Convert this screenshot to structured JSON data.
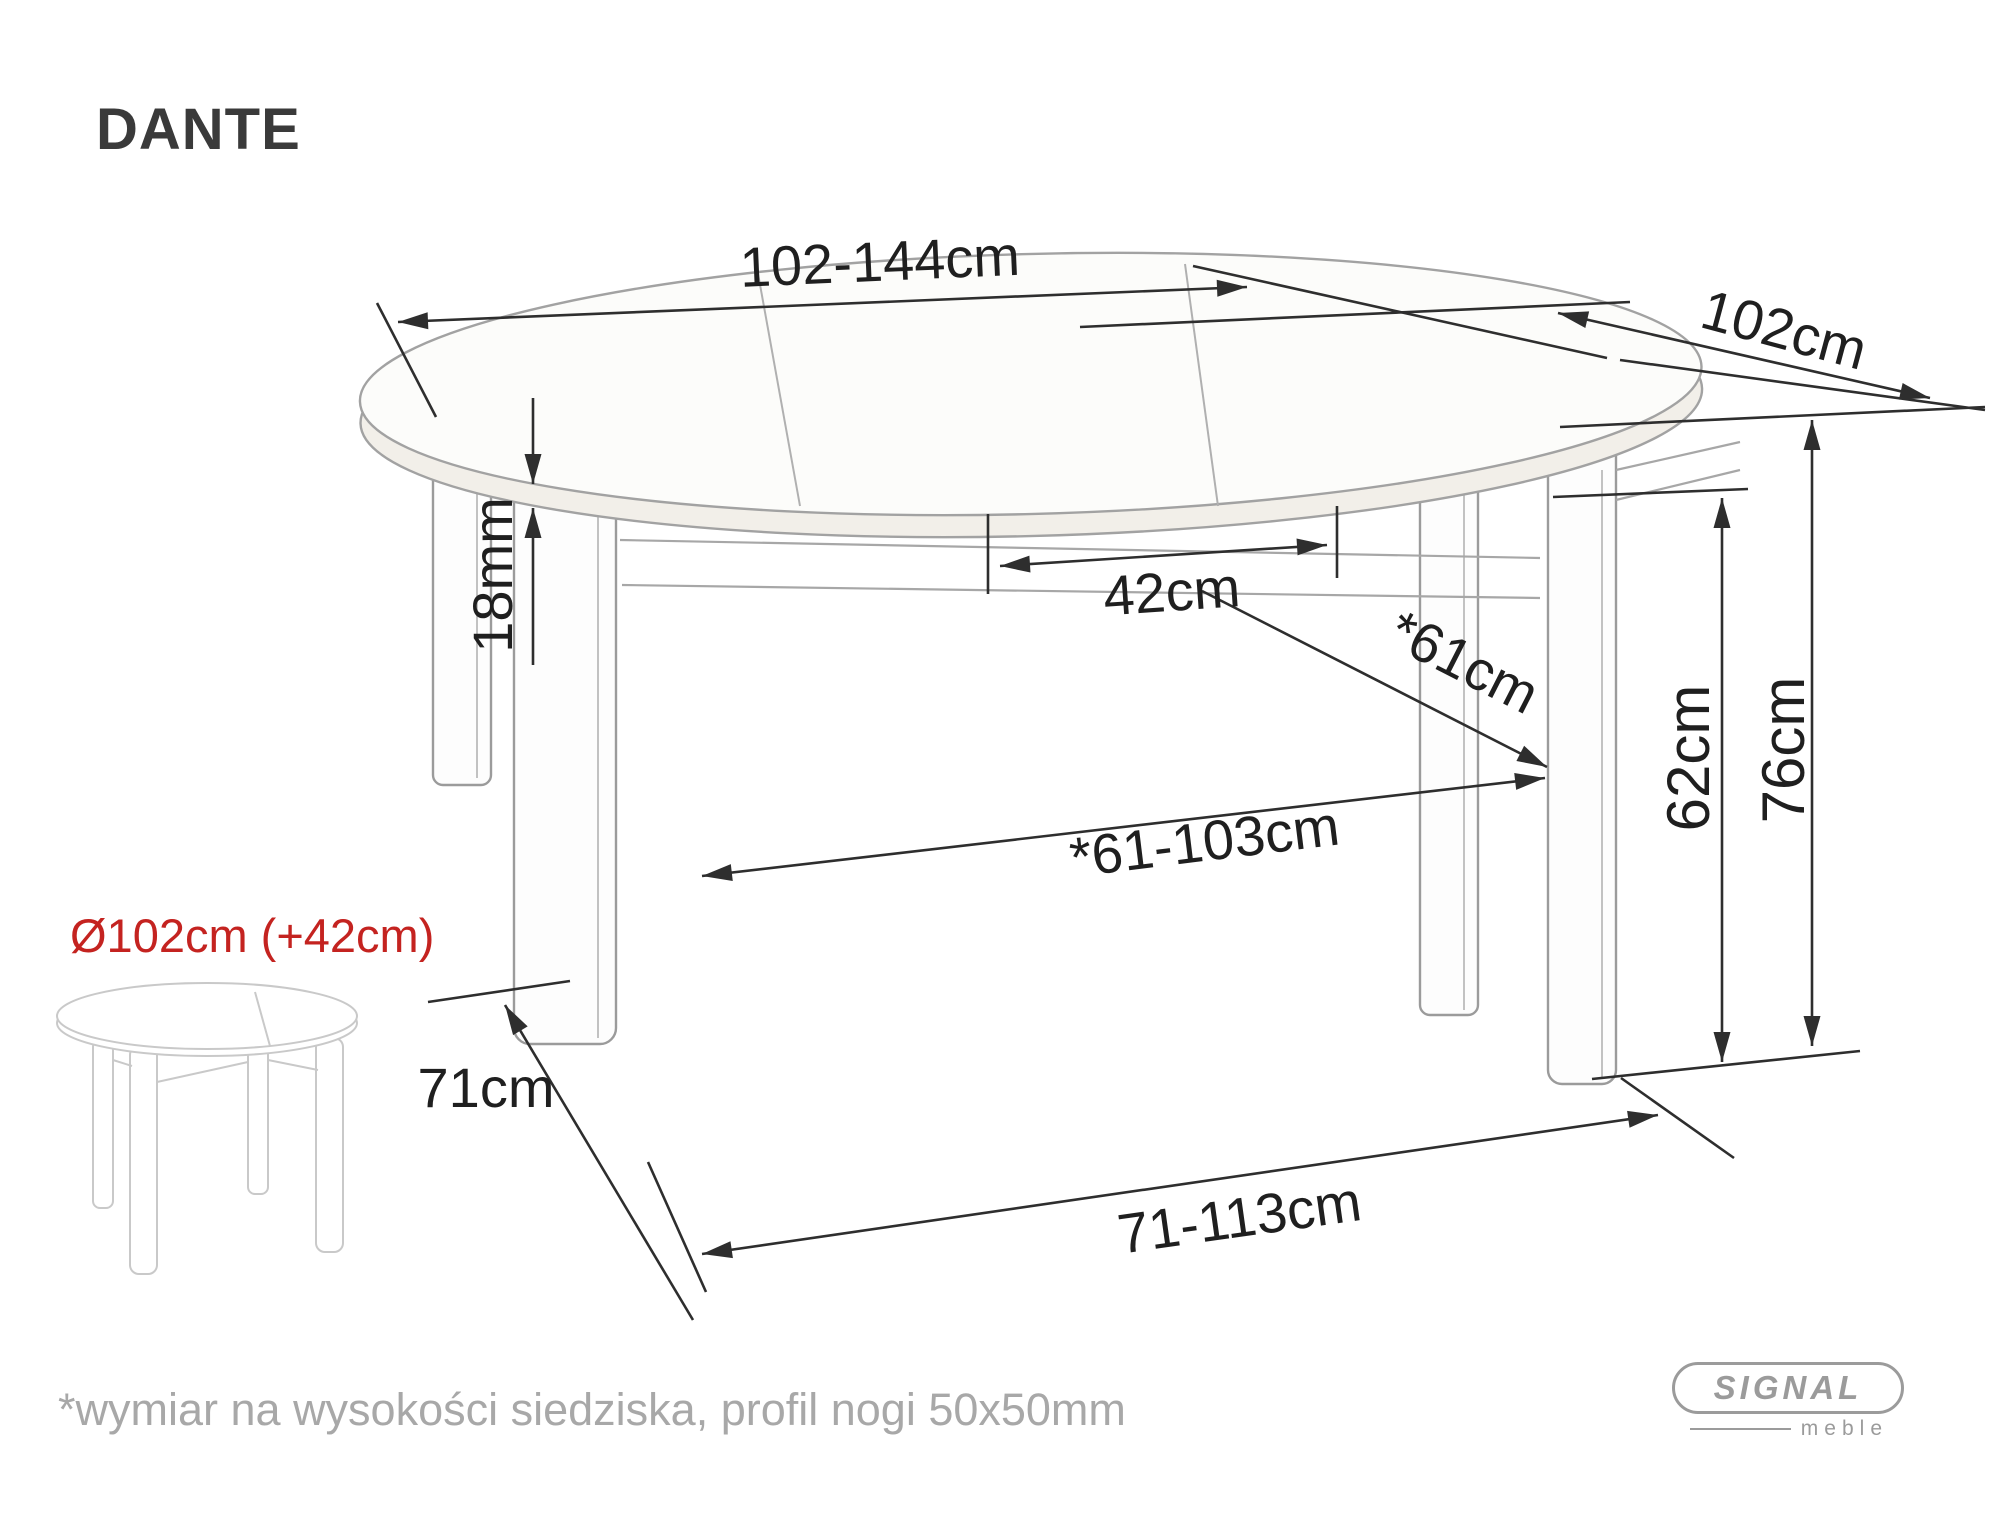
{
  "title": "DANTE",
  "dimensions": {
    "top_length_range": "102-144cm",
    "top_depth": "102cm",
    "top_thickness": "18mm",
    "extension_leaf_width": "42cm",
    "underframe_depth_seat": "*61cm",
    "underframe_width_seat_range": "*61-103cm",
    "underframe_clearance_height": "62cm",
    "table_height": "76cm",
    "leg_span_depth_floor": "71cm",
    "leg_span_width_floor_range": "71-113cm"
  },
  "variant_label": "Ø102cm (+42cm)",
  "footnote": "*wymiar na wysokości siedziska, profil nogi 50x50mm",
  "logo": {
    "brand": "SIGNAL",
    "sub": "meble"
  },
  "colors": {
    "dimension_line": "#2e2e2e",
    "table_outline": "#9b9b9b",
    "small_table_outline": "#c9c9c9",
    "accent_red": "#c42320",
    "muted_text": "#a8a8a8"
  }
}
